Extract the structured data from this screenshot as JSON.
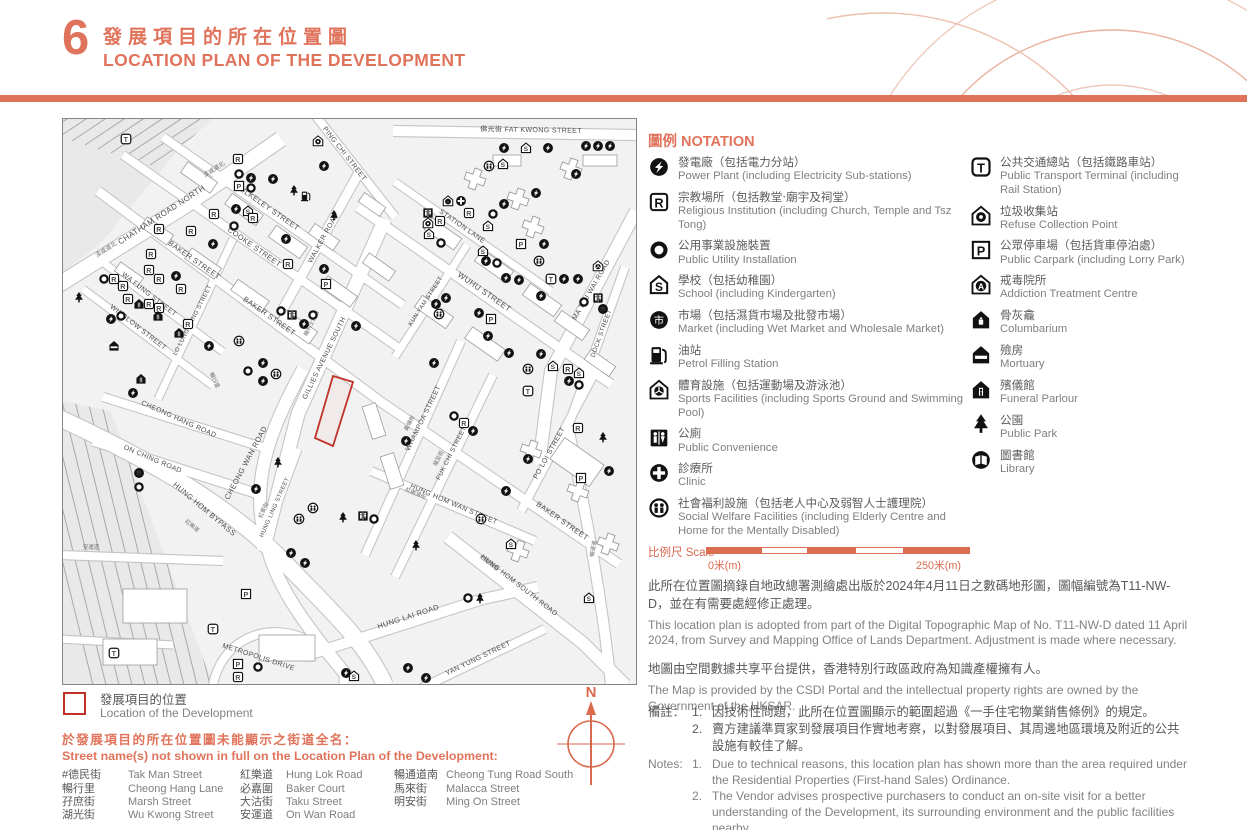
{
  "header": {
    "number": "6",
    "title_zh": "發展項目的所在位置圖",
    "title_en": "LOCATION PLAN OF THE DEVELOPMENT"
  },
  "colors": {
    "accent": "#E0735B",
    "map_red": "#C03228",
    "compass": "#D96A4E"
  },
  "notation": {
    "title": "圖例 NOTATION",
    "columns": [
      [
        {
          "icon": "PP",
          "name": "power-plant",
          "zh": "發電廠（包括電力分站）",
          "en": "Power Plant (including Electricity Sub-stations)"
        },
        {
          "icon": "R",
          "name": "religious-institution",
          "zh": "宗教場所（包括教堂‧廟宇及祠堂）",
          "en": "Religious Institution (including Church, Temple and Tsz Tong)"
        },
        {
          "icon": "O",
          "name": "public-utility-installation",
          "zh": "公用事業設施裝置",
          "en": "Public Utility Installation"
        },
        {
          "icon": "S",
          "name": "school",
          "zh": "學校（包括幼稚園）",
          "en": "School (including Kindergarten)"
        },
        {
          "icon": "M",
          "name": "market",
          "zh": "市場（包括濕貨市場及批發市場）",
          "en": "Market (including Wet Market and Wholesale Market)"
        },
        {
          "icon": "PF",
          "name": "petrol-filling-station",
          "zh": "油站",
          "en": "Petrol Filling Station"
        },
        {
          "icon": "SF",
          "name": "sports-facilities",
          "zh": "體育設施（包括運動場及游泳池）",
          "en": "Sports Facilities (including Sports Ground and Swimming Pool)"
        },
        {
          "icon": "WC",
          "name": "public-convenience",
          "zh": "公廁",
          "en": "Public Convenience"
        },
        {
          "icon": "CL",
          "name": "clinic",
          "zh": "診療所",
          "en": "Clinic"
        },
        {
          "icon": "SW",
          "name": "social-welfare-facilities",
          "zh": "社會福利設施（包括老人中心及弱智人士護理院）",
          "en": "Social Welfare Facilities (including Elderly Centre and Home for the Mentally Disabled)"
        }
      ],
      [
        {
          "icon": "T",
          "name": "public-transport-terminal",
          "zh": "公共交通總站（包括鐵路車站）",
          "en": "Public Transport Terminal (including Rail Station)"
        },
        {
          "icon": "RC",
          "name": "refuse-collection-point",
          "zh": "垃圾收集站",
          "en": "Refuse Collection Point"
        },
        {
          "icon": "P",
          "name": "public-carpark",
          "zh": "公眾停車場（包括貨車停泊處）",
          "en": "Public Carpark (including Lorry Park)"
        },
        {
          "icon": "A",
          "name": "addiction-treatment-centre",
          "zh": "戒毒院所",
          "en": "Addiction Treatment Centre"
        },
        {
          "icon": "CO",
          "name": "columbarium",
          "zh": "骨灰龕",
          "en": "Columbarium"
        },
        {
          "icon": "MO",
          "name": "mortuary",
          "zh": "殮房",
          "en": "Mortuary"
        },
        {
          "icon": "FU",
          "name": "funeral-parlour",
          "zh": "殯儀館",
          "en": "Funeral Parlour"
        },
        {
          "icon": "PK",
          "name": "public-park",
          "zh": "公園",
          "en": "Public Park"
        },
        {
          "icon": "LB",
          "name": "library",
          "zh": "圖書館",
          "en": "Library"
        }
      ]
    ]
  },
  "scale": {
    "label": "比例尺 Scale",
    "start": "0米(m)",
    "end": "250米(m)"
  },
  "source_paragraphs": [
    {
      "zh": "此所在位置圖摘錄自地政總署測繪處出版於2024年4月11日之數碼地形圖，圖幅編號為T11-NW-D，並在有需要處經修正處理。",
      "en": "This location plan is adopted from part of the Digital Topographic Map of No. T11-NW-D dated 11 April 2024, from Survey and Mapping Office of Lands Department. Adjustment is made where necessary."
    },
    {
      "zh": "地圖由空間數據共享平台提供，香港特別行政區政府為知識產權擁有人。",
      "en": "The Map is provided by the CSDI Portal and the intellectual property rights are owned by the Government of the HKSAR."
    }
  ],
  "notes": {
    "label_zh": "備註：",
    "label_en": "Notes:",
    "zh_items": [
      {
        "num": "1.",
        "text": "因技術性問題，此所在位置圖顯示的範圍超過《一手住宅物業銷售條例》的規定。"
      },
      {
        "num": "2.",
        "text": "賣方建議準買家到發展項目作實地考察，以對發展項目、其周邊地區環境及附近的公共設施有較佳了解。"
      }
    ],
    "en_items": [
      {
        "num": "1.",
        "text": "Due to technical reasons, this location plan has shown more than the area required under the Residential Properties (First-hand Sales) Ordinance."
      },
      {
        "num": "2.",
        "text": "The Vendor advises prospective purchasers to conduct an on-site visit for a better understanding of the Development, its surrounding environment and the public facilities nearby."
      }
    ]
  },
  "location_marker": {
    "zh": "發展項目的位置",
    "en": "Location of the Development"
  },
  "street_names": {
    "heading_zh": "於發展項目的所在位置圖未能顯示之街道全名：",
    "heading_en": "Street name(s) not shown in full on the Location Plan of the Development:",
    "columns": [
      [
        {
          "zh": "#德民街",
          "en": "Tak Man Street"
        },
        {
          "zh": "暢行里",
          "en": "Cheong Hang Lane"
        },
        {
          "zh": "孖庶街",
          "en": "Marsh Street"
        },
        {
          "zh": "湖光街",
          "en": "Wu Kwong Street"
        }
      ],
      [
        {
          "zh": "紅樂道",
          "en": "Hung Lok Road"
        },
        {
          "zh": "必嘉圍",
          "en": "Baker Court"
        },
        {
          "zh": "大沽街",
          "en": "Taku Street"
        },
        {
          "zh": "安運道",
          "en": "On Wan Road"
        }
      ],
      [
        {
          "zh": "暢通道南",
          "en": "Cheong Tung Road South"
        },
        {
          "zh": "馬來街",
          "en": "Malacca Street"
        },
        {
          "zh": "明安街",
          "en": "Ming On Street"
        }
      ]
    ]
  },
  "compass_label": "N",
  "map": {
    "street_labels": [
      [
        "CHATHAM ROAD NORTH",
        100,
        98,
        -33,
        8
      ],
      [
        "漆咸道北",
        44,
        132,
        -33,
        6
      ],
      [
        "漆咸道北",
        152,
        52,
        -33,
        6
      ],
      [
        "PING CHI STREET",
        280,
        36,
        52,
        7
      ],
      [
        "佛光街 FAT KWONG STREET",
        468,
        13,
        1,
        7
      ],
      [
        "BULKELEY STREET",
        203,
        90,
        35,
        7.5
      ],
      [
        "COOKE STREET",
        190,
        130,
        35,
        7.5
      ],
      [
        "BAKER STREET",
        130,
        143,
        35,
        7.5
      ],
      [
        "BAKER STREET",
        205,
        199,
        35,
        7.5
      ],
      [
        "BAKER STREET",
        498,
        404,
        35,
        7.5
      ],
      [
        "WALKER ROAD",
        262,
        120,
        -61,
        7
      ],
      [
        "WUHU STREET",
        420,
        175,
        35,
        8
      ],
      [
        "STATION LANE",
        398,
        109,
        35,
        7
      ],
      [
        "KUN YAM STREET",
        364,
        183,
        -57,
        6
      ],
      [
        "MA TAU WAI ROAD",
        530,
        172,
        -60,
        7
      ],
      [
        "DOCK STREET",
        540,
        215,
        -70,
        6.5
      ],
      [
        "PO LOI STREET",
        488,
        335,
        -61,
        7
      ],
      [
        "GILLIES AVENUE SOUTH",
        263,
        240,
        -64,
        7
      ],
      [
        "機利士南道",
        250,
        205,
        -64,
        5.5
      ],
      [
        "WHAMPOA STREET",
        362,
        300,
        -64,
        7
      ],
      [
        "黃埔街",
        348,
        305,
        -64,
        5.5
      ],
      [
        "FUK CHI STREET",
        390,
        335,
        -63,
        6.5
      ],
      [
        "福至街",
        377,
        340,
        -63,
        5.5
      ],
      [
        "LO LUNG HANG STREET",
        131,
        202,
        -63,
        6
      ],
      [
        "WA FUNG STREET",
        85,
        177,
        38,
        7
      ],
      [
        "WINSLOW STREET",
        74,
        210,
        38,
        7
      ],
      [
        "CHEONG HANG ROAD",
        115,
        302,
        24,
        7
      ],
      [
        "ON CHING ROAD",
        89,
        342,
        23,
        7
      ],
      [
        "CHEONG WAN ROAD",
        185,
        345,
        -62,
        7.5
      ],
      [
        "HUNG HOM BYPASS",
        140,
        392,
        40,
        7.5
      ],
      [
        "HUNG LING STREET",
        213,
        389,
        -66,
        6
      ],
      [
        "紅菱街",
        202,
        392,
        -66,
        5.5
      ],
      [
        "HUNG HOM WAN STREET",
        390,
        387,
        23,
        7
      ],
      [
        "紅磡灣街",
        352,
        376,
        23,
        5.5
      ],
      [
        "紅磡南道",
        425,
        445,
        38,
        5.5
      ],
      [
        "HUNG HOM SOUTH ROAD",
        455,
        468,
        38,
        7
      ],
      [
        "HUNG LAI ROAD",
        346,
        500,
        -18,
        7.5
      ],
      [
        "YAN YUNG STREET",
        416,
        541,
        -26,
        7
      ],
      [
        "METROPOLIS DRIVE",
        195,
        540,
        18,
        7
      ],
      [
        "暢運道",
        532,
        430,
        -80,
        5.5
      ],
      [
        "安運道",
        28,
        430,
        0,
        5.5
      ],
      [
        "暢行里",
        150,
        262,
        65,
        5.5
      ],
      [
        "紅樂道",
        128,
        408,
        40,
        5.5
      ]
    ],
    "icons": [
      [
        "T",
        63,
        20
      ],
      [
        "RC",
        255,
        22
      ],
      [
        "R",
        175,
        40
      ],
      [
        "O",
        176,
        55
      ],
      [
        "PP",
        188,
        59
      ],
      [
        "PP",
        210,
        60
      ],
      [
        "P",
        176,
        67
      ],
      [
        "O",
        188,
        69
      ],
      [
        "PK",
        231,
        72
      ],
      [
        "PF",
        243,
        77
      ],
      [
        "PP",
        261,
        47
      ],
      [
        "PK",
        271,
        97
      ],
      [
        "R",
        151,
        95
      ],
      [
        "PP",
        173,
        90
      ],
      [
        "S",
        185,
        92
      ],
      [
        "R",
        190,
        99
      ],
      [
        "O",
        171,
        107
      ],
      [
        "R",
        96,
        110
      ],
      [
        "R",
        128,
        112
      ],
      [
        "PP",
        150,
        125
      ],
      [
        "PP",
        223,
        120
      ],
      [
        "R",
        225,
        145
      ],
      [
        "PP",
        261,
        150
      ],
      [
        "P",
        263,
        165
      ],
      [
        "R",
        88,
        135
      ],
      [
        "R",
        86,
        151
      ],
      [
        "R",
        96,
        160
      ],
      [
        "PP",
        113,
        157
      ],
      [
        "R",
        51,
        160
      ],
      [
        "O",
        41,
        160
      ],
      [
        "R",
        60,
        167
      ],
      [
        "R",
        118,
        170
      ],
      [
        "R",
        65,
        180
      ],
      [
        "FU",
        76,
        185
      ],
      [
        "R",
        86,
        185
      ],
      [
        "R",
        96,
        189
      ],
      [
        "FU",
        95,
        197
      ],
      [
        "R",
        125,
        205
      ],
      [
        "PP",
        48,
        200
      ],
      [
        "O",
        58,
        197
      ],
      [
        "FU",
        116,
        214
      ],
      [
        "MO",
        51,
        227
      ],
      [
        "SW",
        176,
        222
      ],
      [
        "PP",
        146,
        227
      ],
      [
        "FU",
        78,
        260
      ],
      [
        "PP",
        70,
        274
      ],
      [
        "PP",
        200,
        244
      ],
      [
        "O",
        185,
        252
      ],
      [
        "PP",
        200,
        262
      ],
      [
        "SW",
        213,
        255
      ],
      [
        "PP",
        241,
        205
      ],
      [
        "WC",
        229,
        196
      ],
      [
        "O",
        218,
        192
      ],
      [
        "O",
        250,
        196
      ],
      [
        "PK",
        16,
        179
      ],
      [
        "PP",
        441,
        29
      ],
      [
        "S",
        463,
        29
      ],
      [
        "PP",
        485,
        29
      ],
      [
        "PP",
        523,
        27
      ],
      [
        "PP",
        535,
        27
      ],
      [
        "PP",
        547,
        27
      ],
      [
        "PP",
        513,
        55
      ],
      [
        "SW",
        426,
        47
      ],
      [
        "S",
        440,
        45
      ],
      [
        "PP",
        473,
        74
      ],
      [
        "A",
        385,
        82
      ],
      [
        "CL",
        398,
        82
      ],
      [
        "R",
        406,
        94
      ],
      [
        "O",
        430,
        95
      ],
      [
        "WC",
        365,
        94
      ],
      [
        "RC",
        365,
        104
      ],
      [
        "R",
        377,
        102
      ],
      [
        "S",
        366,
        115
      ],
      [
        "O",
        378,
        124
      ],
      [
        "S",
        425,
        107
      ],
      [
        "PP",
        441,
        85
      ],
      [
        "S",
        420,
        132
      ],
      [
        "PP",
        423,
        142
      ],
      [
        "O",
        434,
        144
      ],
      [
        "P",
        458,
        125
      ],
      [
        "PP",
        481,
        125
      ],
      [
        "SW",
        476,
        142
      ],
      [
        "PP",
        443,
        159
      ],
      [
        "PP",
        456,
        161
      ],
      [
        "T",
        488,
        160
      ],
      [
        "PP",
        501,
        160
      ],
      [
        "PP",
        515,
        160
      ],
      [
        "PP",
        478,
        177
      ],
      [
        "PP",
        383,
        179
      ],
      [
        "PP",
        373,
        185
      ],
      [
        "SW",
        376,
        195
      ],
      [
        "M",
        540,
        190
      ],
      [
        "WC",
        535,
        179
      ],
      [
        "O",
        521,
        183
      ],
      [
        "P",
        428,
        200
      ],
      [
        "PP",
        416,
        194
      ],
      [
        "PP",
        425,
        217
      ],
      [
        "PP",
        446,
        234
      ],
      [
        "PP",
        478,
        235
      ],
      [
        "SW",
        465,
        250
      ],
      [
        "S",
        490,
        247
      ],
      [
        "R",
        505,
        250
      ],
      [
        "S",
        516,
        254
      ],
      [
        "PP",
        506,
        262
      ],
      [
        "O",
        516,
        266
      ],
      [
        "T",
        465,
        272
      ],
      [
        "SF",
        535,
        147
      ],
      [
        "PP",
        293,
        207
      ],
      [
        "PP",
        371,
        244
      ],
      [
        "M",
        76,
        354
      ],
      [
        "O",
        76,
        368
      ],
      [
        "PP",
        193,
        370
      ],
      [
        "PK",
        215,
        344
      ],
      [
        "SW",
        250,
        389
      ],
      [
        "SW",
        236,
        400
      ],
      [
        "PK",
        280,
        399
      ],
      [
        "PP",
        228,
        434
      ],
      [
        "PP",
        242,
        444
      ],
      [
        "P",
        183,
        475
      ],
      [
        "T",
        150,
        510
      ],
      [
        "T",
        51,
        534
      ],
      [
        "P",
        175,
        545
      ],
      [
        "O",
        195,
        548
      ],
      [
        "R",
        175,
        558
      ],
      [
        "PP",
        283,
        554
      ],
      [
        "O",
        391,
        297
      ],
      [
        "R",
        401,
        304
      ],
      [
        "PP",
        410,
        312
      ],
      [
        "PP",
        343,
        322
      ],
      [
        "PP",
        465,
        340
      ],
      [
        "R",
        515,
        309
      ],
      [
        "PK",
        540,
        319
      ],
      [
        "P",
        518,
        359
      ],
      [
        "PP",
        546,
        352
      ],
      [
        "PP",
        443,
        372
      ],
      [
        "SW",
        418,
        400
      ],
      [
        "WC",
        300,
        397
      ],
      [
        "O",
        311,
        400
      ],
      [
        "PK",
        353,
        427
      ],
      [
        "O",
        405,
        479
      ],
      [
        "PK",
        417,
        480
      ],
      [
        "S",
        448,
        425
      ],
      [
        "S",
        526,
        479
      ],
      [
        "PP",
        345,
        549
      ],
      [
        "PP",
        363,
        559
      ],
      [
        "S",
        291,
        557
      ]
    ]
  }
}
